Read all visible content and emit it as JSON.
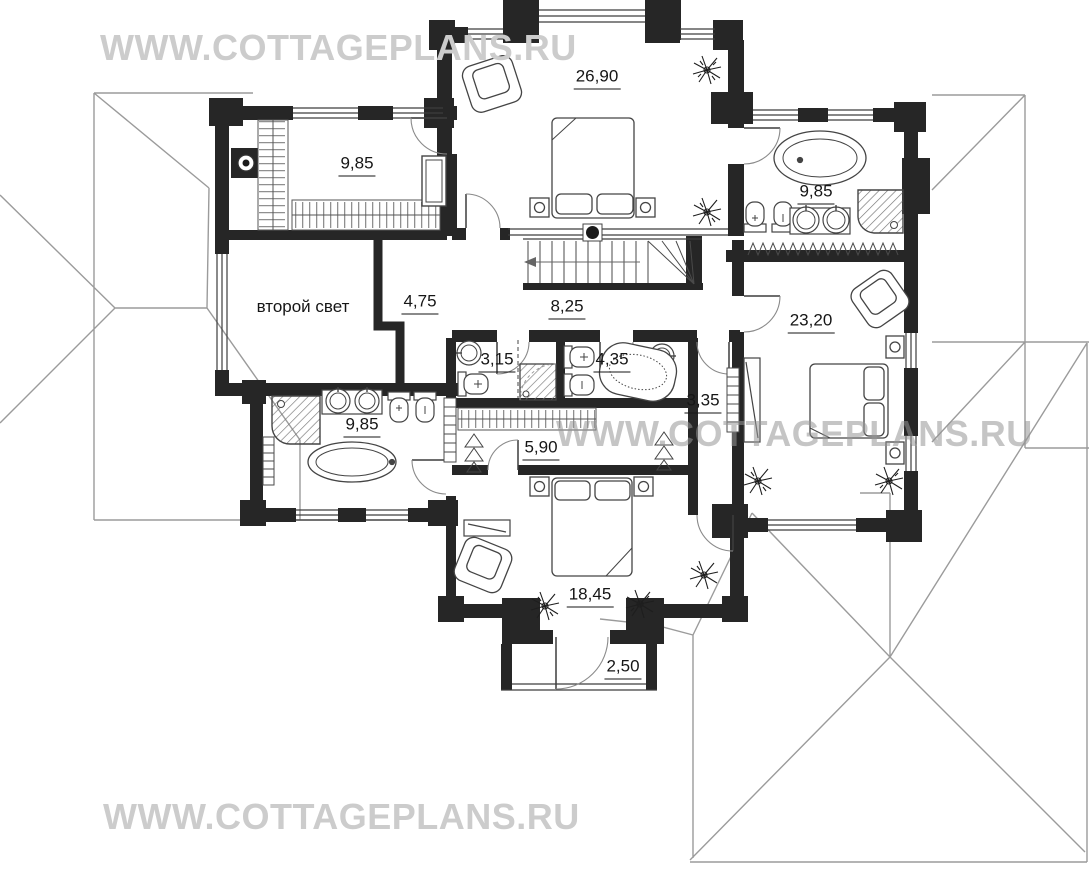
{
  "watermarks": {
    "top": "WWW.COTTAGEPLANS.RU",
    "middle": "WWW.COTTAGEPLANS.RU",
    "bottom": "WWW.COTTAGEPLANS.RU"
  },
  "plan": {
    "void_label": "второй свет",
    "rooms": [
      {
        "id": "bedroom-top",
        "area": "26,90"
      },
      {
        "id": "dressing-top-left",
        "area": "9,85"
      },
      {
        "id": "bathroom-top-right",
        "area": "9,85"
      },
      {
        "id": "corridor",
        "area": "4,75"
      },
      {
        "id": "hall",
        "area": "8,25"
      },
      {
        "id": "bedroom-right",
        "area": "23,20"
      },
      {
        "id": "wc-left",
        "area": "3,15"
      },
      {
        "id": "wc-right",
        "area": "4,35"
      },
      {
        "id": "closet-corridor",
        "area": "3,35"
      },
      {
        "id": "bathroom-left",
        "area": "9,85"
      },
      {
        "id": "wardrobe",
        "area": "5,90"
      },
      {
        "id": "bedroom-bottom",
        "area": "18,45"
      },
      {
        "id": "balcony",
        "area": "2,50"
      }
    ]
  },
  "colors": {
    "wall": "#262626",
    "roof_line": "#9b9b9b",
    "watermark": "#cccccc",
    "label": "#161616"
  }
}
